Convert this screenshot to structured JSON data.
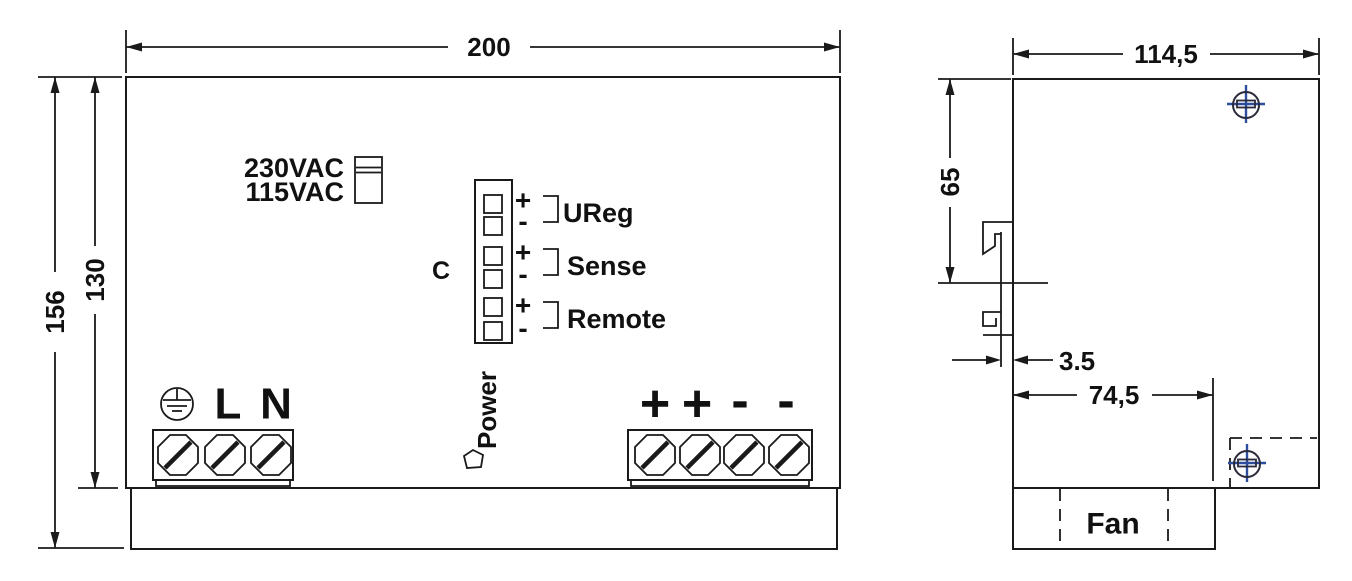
{
  "front_view": {
    "dims": {
      "width": "200",
      "height_total": "156",
      "height_body": "130"
    },
    "voltage_selector": {
      "line1": "230VAC",
      "line2": "115VAC"
    },
    "connector": {
      "label": "C",
      "rows": [
        {
          "plus": "+",
          "minus": "-",
          "name": "UReg"
        },
        {
          "plus": "+",
          "minus": "-",
          "name": "Sense"
        },
        {
          "plus": "+",
          "minus": "-",
          "name": "Remote"
        }
      ]
    },
    "power_indicator": {
      "label": "Power"
    },
    "ac_input": {
      "line": "L",
      "neutral": "N"
    },
    "dc_output": {
      "labels": [
        "+",
        "+",
        "-",
        "-"
      ]
    }
  },
  "side_view": {
    "dims": {
      "width": "114,5",
      "din_clip_top": "65",
      "clip_depth": "3.5",
      "fan_offset": "74,5"
    },
    "fan_label": "Fan"
  },
  "colors": {
    "line": "#1a1a1a",
    "screw_accent": "#2d4e9e"
  }
}
